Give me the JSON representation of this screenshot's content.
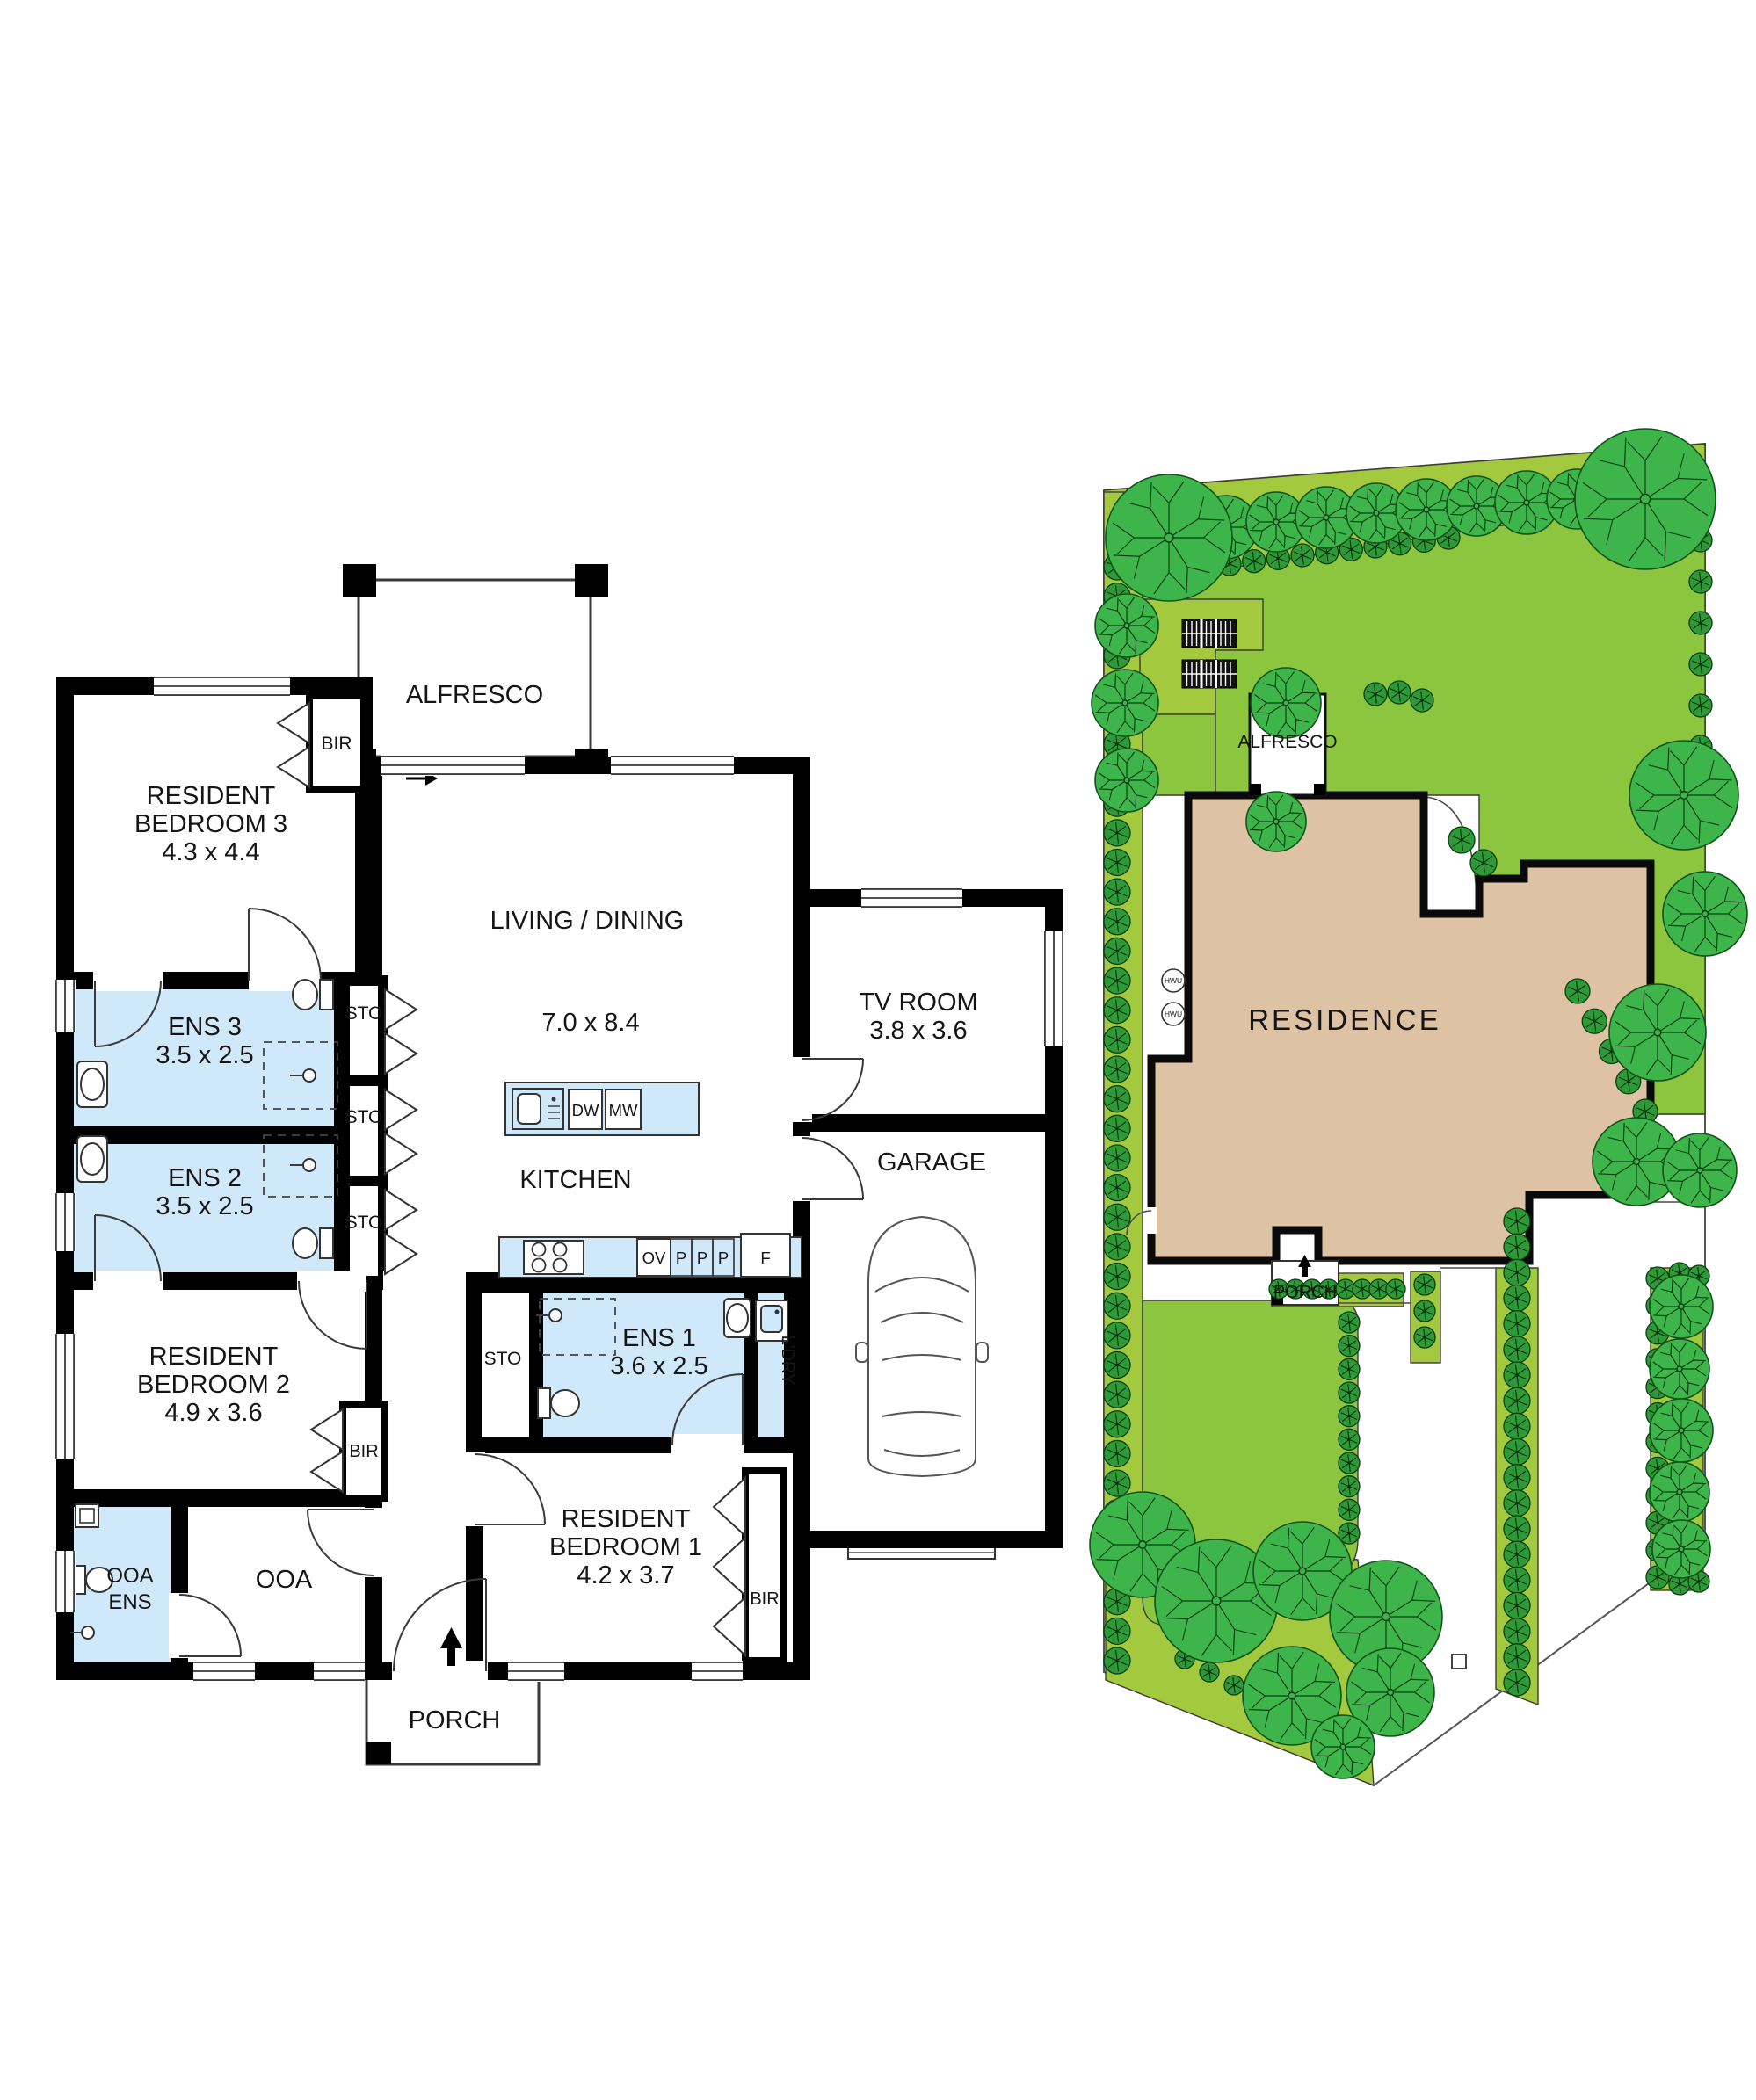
{
  "palette": {
    "wall": "#000000",
    "wet_area": "#cfe8fa",
    "bench": "#cfe8fa",
    "residence": "#ddc3a4",
    "lawn": "#8cc63e",
    "garden_bed": "#a3c93f",
    "tree": "#3db54a",
    "shrub": "#2e9937",
    "outline": "#3a3a3a",
    "text": "#151515"
  },
  "floorplan": {
    "alfresco": "ALFRESCO",
    "bedroom3": {
      "lines": [
        "RESIDENT",
        "BEDROOM 3"
      ],
      "dims": "4.3 x 4.4"
    },
    "ens3": {
      "name": "ENS 3",
      "dims": "3.5 x 2.5"
    },
    "ens2": {
      "name": "ENS 2",
      "dims": "3.5 x 2.5"
    },
    "living": {
      "name": "LIVING / DINING",
      "dims": "7.0 x 8.4"
    },
    "kitchen": "KITCHEN",
    "tv": {
      "name": "TV ROOM",
      "dims": "3.8 x 3.6"
    },
    "garage": "GARAGE",
    "ens1": {
      "name": "ENS 1",
      "dims": "3.6 x 2.5"
    },
    "laundry": "L'DRY",
    "bedroom2": {
      "lines": [
        "RESIDENT",
        "BEDROOM 2"
      ],
      "dims": "4.9 x 3.6"
    },
    "bedroom1": {
      "lines": [
        "RESIDENT",
        "BEDROOM 1"
      ],
      "dims": "4.2 x 3.7"
    },
    "ooa": "OOA",
    "ooa_ens": {
      "lines": [
        "OOA",
        "ENS"
      ]
    },
    "porch": "PORCH",
    "sto": "STO",
    "bir": "BIR",
    "appliances": {
      "dw": "DW",
      "mw": "MW",
      "ov": "OV",
      "p": "P",
      "f": "F"
    }
  },
  "siteplan": {
    "residence": "RESIDENCE",
    "alfresco": "ALFRESCO",
    "porch": "PORCH",
    "hwu": "HWU"
  }
}
